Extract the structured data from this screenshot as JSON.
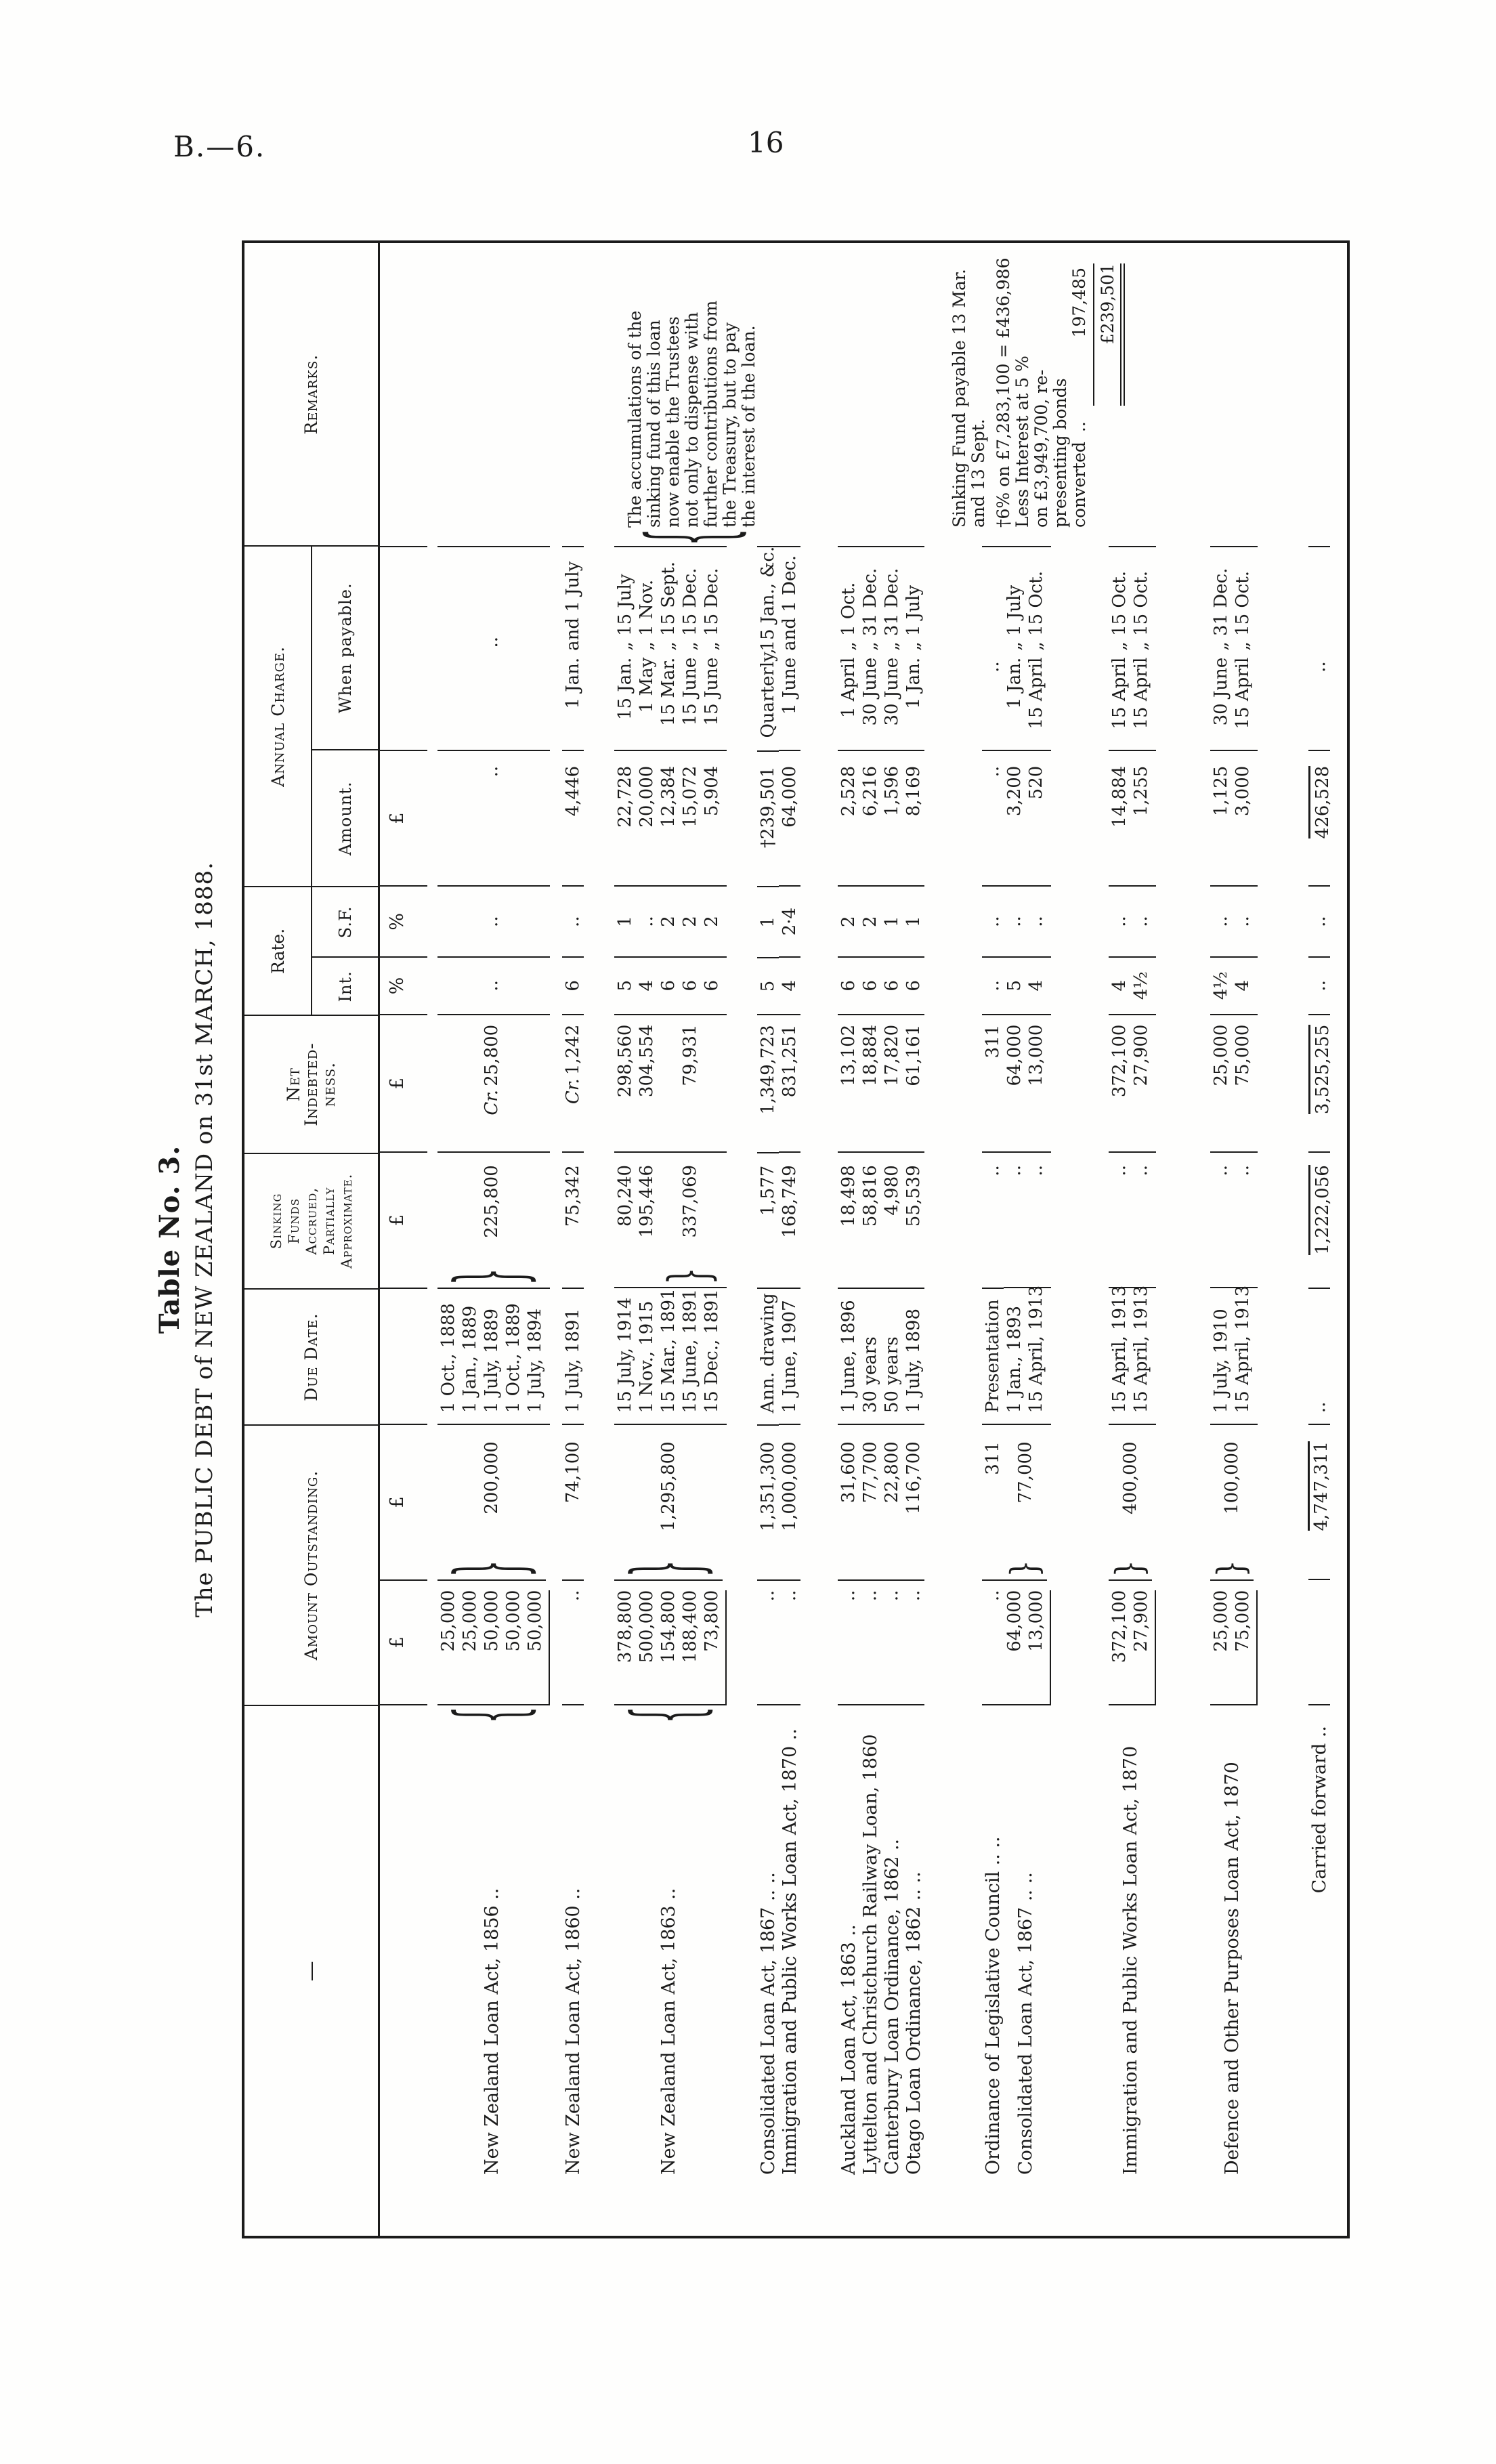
{
  "page": {
    "doc_ref": "B.—6.",
    "page_number": "16"
  },
  "title": {
    "table_no": "Table No. 3.",
    "subtitle": "The PUBLIC DEBT of NEW ZEALAND on 31st MARCH, 1888."
  },
  "table": {
    "headers": {
      "name": "—",
      "amount_outstanding": "Amount Outstanding.",
      "due_date": "Due Date.",
      "sinking_funds": [
        "Sinking",
        "Funds",
        "Accrued,",
        "Partially",
        "Approximate."
      ],
      "net_indebtedness": [
        "Net",
        "Indebted-",
        "ness."
      ],
      "rate": "Rate.",
      "rate_int": "Int.",
      "rate_sf": "S.F.",
      "annual_charge": "Annual Charge.",
      "amount": "Amount.",
      "when_payable": "When payable.",
      "remarks": "Remarks."
    },
    "units": {
      "pound": "£",
      "percent": "%"
    },
    "rows": [
      {
        "n": 5,
        "name": "New Zealand Loan Act, 1856",
        "dots": " ..",
        "name_brace": 5,
        "items": [
          "25,000",
          "25,000",
          "50,000",
          "50,000",
          "50,000"
        ],
        "items_rule": true,
        "total": "200,000",
        "total_brace": 5,
        "due": [
          "1 Oct., 1888",
          "1 Jan., 1889",
          "1 July, 1889",
          "1 Oct., 1889",
          "1 July, 1894"
        ],
        "sink": [],
        "sink_brace": {
          "span": 5,
          "value": "225,800"
        },
        "net": [],
        "net_center": {
          "span": 5,
          "value": "Cr. 25,800"
        },
        "int": {
          "span": 5,
          "value": ".."
        },
        "sf": {
          "span": 5,
          "value": ".."
        },
        "amt": {
          "span": 5,
          "value": ".."
        },
        "when": {
          "span": 5,
          "value": ".."
        }
      },
      {
        "n": 1,
        "name": "New Zealand Loan Act, 1860",
        "dots": " ..",
        "items": [
          ".."
        ],
        "total": "74,100",
        "due": [
          "1 July, 1891"
        ],
        "sink": [
          "75,342"
        ],
        "net": [
          "Cr. 1,242"
        ],
        "int": [
          "6"
        ],
        "sf": [
          ".."
        ],
        "amt": [
          "4,446"
        ],
        "when": [
          [
            "1 Jan.",
            "and 1 July"
          ]
        ]
      },
      {
        "n": 5,
        "name": "New Zealand Loan Act, 1863",
        "dots": " ..",
        "name_brace": 5,
        "items": [
          "378,800",
          "500,000",
          "154,800",
          "188,400",
          "73,800"
        ],
        "items_rule": true,
        "total": "1,295,800",
        "total_brace": 5,
        "due": [
          "15 July, 1914",
          "1 Nov., 1915",
          "15 Mar., 1891",
          "15 June, 1891",
          "15 Dec., 1891"
        ],
        "sink": [
          "80,240",
          "195,446"
        ],
        "sink_brace": {
          "span": 3,
          "value": "337,069"
        },
        "net": [
          "298,560",
          "304,554"
        ],
        "net_center": {
          "span": 3,
          "value": "79,931"
        },
        "int": [
          "5",
          "4",
          "6",
          "6",
          "6"
        ],
        "sf": [
          "1",
          "..",
          "2",
          "2",
          "2"
        ],
        "amt": [
          "22,728",
          "20,000",
          "12,384",
          "15,072",
          "5,904"
        ],
        "when": [
          [
            "15 Jan.",
            "„ 15 July"
          ],
          [
            "1 May",
            "„ 1 Nov."
          ],
          [
            "15 Mar.",
            "„ 15 Sept."
          ],
          [
            "15 June",
            "„ 15 Dec."
          ],
          [
            "15 June",
            "„ 15 Dec."
          ]
        ]
      },
      {
        "n": 1,
        "name": "Consolidated Loan Act, 1867",
        "dots": " .. ..",
        "items": [
          ".."
        ],
        "total": "1,351,300",
        "due": [
          "Ann. drawing"
        ],
        "sink": [
          "1,577"
        ],
        "net": [
          "1,349,723"
        ],
        "int": [
          "5"
        ],
        "sf": [
          "1"
        ],
        "amt": [
          "†239,501"
        ],
        "when": [
          [
            "Quarterly,",
            "15 Jan., &c."
          ]
        ]
      },
      {
        "n": 1,
        "name": "Immigration and Public Works Loan Act, 1870",
        "dots": " ..",
        "items": [
          ".."
        ],
        "total": "1,000,000",
        "due": [
          "1 June, 1907"
        ],
        "sink": [
          "168,749"
        ],
        "net": [
          "831,251"
        ],
        "int": [
          "4"
        ],
        "sf": [
          "2·4"
        ],
        "amt": [
          "64,000"
        ],
        "when": [
          [
            "1 June",
            "and 1 Dec."
          ]
        ]
      },
      {
        "n": 1,
        "name": "Auckland Loan Act, 1863",
        "dots": " ..",
        "items": [
          ".."
        ],
        "total": "31,600",
        "due": [
          "1 June, 1896"
        ],
        "sink": [
          "18,498"
        ],
        "net": [
          "13,102"
        ],
        "int": [
          "6"
        ],
        "sf": [
          "2"
        ],
        "amt": [
          "2,528"
        ],
        "when": [
          [
            "1 April",
            "„ 1 Oct."
          ]
        ]
      },
      {
        "n": 1,
        "name": "Lyttelton and Christchurch Railway Loan, 1860",
        "dots": "",
        "items": [
          ".."
        ],
        "total": "77,700",
        "due": [
          "30 years"
        ],
        "sink": [
          "58,816"
        ],
        "net": [
          "18,884"
        ],
        "int": [
          "6"
        ],
        "sf": [
          "2"
        ],
        "amt": [
          "6,216"
        ],
        "when": [
          [
            "30 June",
            "„ 31 Dec."
          ]
        ]
      },
      {
        "n": 1,
        "name": "Canterbury Loan Ordinance, 1862",
        "dots": " ..",
        "items": [
          ".."
        ],
        "total": "22,800",
        "due": [
          "50 years"
        ],
        "sink": [
          "4,980"
        ],
        "net": [
          "17,820"
        ],
        "int": [
          "6"
        ],
        "sf": [
          "1"
        ],
        "amt": [
          "1,596"
        ],
        "when": [
          [
            "30 June",
            "„ 31 Dec."
          ]
        ]
      },
      {
        "n": 1,
        "name": "Otago Loan Ordinance, 1862",
        "dots": " .. ..",
        "items": [
          ".."
        ],
        "total": "116,700",
        "due": [
          "1 July, 1898"
        ],
        "sink": [
          "55,539"
        ],
        "net": [
          "61,161"
        ],
        "int": [
          "6"
        ],
        "sf": [
          "1"
        ],
        "amt": [
          "8,169"
        ],
        "when": [
          [
            "1 Jan.",
            "„ 1 July"
          ]
        ]
      },
      {
        "n": 1,
        "name": "Ordinance of Legislative Council",
        "dots": " .. ..",
        "items": [
          ".."
        ],
        "total": "311",
        "due": [
          "Presentation"
        ],
        "sink": [
          ".."
        ],
        "net": [
          "311"
        ],
        "int": [
          ".."
        ],
        "sf": [
          ".."
        ],
        "amt": [
          ".."
        ],
        "when": [
          ".."
        ]
      },
      {
        "n": 2,
        "name": "Consolidated Loan Act, 1867",
        "dots": " .. ..",
        "items": [
          "64,000",
          "13,000"
        ],
        "items_rule": true,
        "total": "77,000",
        "total_brace": 2,
        "due": [
          "1 Jan., 1893",
          "15 April, 1913"
        ],
        "sink": [
          "..",
          ".."
        ],
        "net": [
          "64,000",
          "13,000"
        ],
        "int": [
          "5",
          "4"
        ],
        "sf": [
          "..",
          ".."
        ],
        "amt": [
          "3,200",
          "520"
        ],
        "when": [
          [
            "1 Jan.",
            "„ 1 July"
          ],
          [
            "15 April",
            "„ 15 Oct."
          ]
        ]
      },
      {
        "n": 2,
        "name": "Immigration and Public Works Loan Act, 1870",
        "dots": "",
        "items": [
          "372,100",
          "27,900"
        ],
        "items_rule": true,
        "total": "400,000",
        "total_brace": 2,
        "due": [
          "15 April, 1913",
          "15 April, 1913"
        ],
        "sink": [
          "..",
          ".."
        ],
        "net": [
          "372,100",
          "27,900"
        ],
        "int": [
          "4",
          "4½"
        ],
        "sf": [
          "..",
          ".."
        ],
        "amt": [
          "14,884",
          "1,255"
        ],
        "when": [
          [
            "15 April",
            "„ 15 Oct."
          ],
          [
            "15 April",
            "„ 15 Oct."
          ]
        ]
      },
      {
        "n": 2,
        "name": "Defence and Other Purposes Loan Act, 1870",
        "dots": "",
        "items": [
          "25,000",
          "75,000"
        ],
        "items_rule": true,
        "total": "100,000",
        "total_brace": 2,
        "due": [
          "1 July, 1910",
          "15 April, 1913"
        ],
        "sink": [
          "..",
          ".."
        ],
        "net": [
          "25,000",
          "75,000"
        ],
        "int": [
          "4½",
          "4"
        ],
        "sf": [
          "..",
          ".."
        ],
        "amt": [
          "1,125",
          "3,000"
        ],
        "when": [
          [
            "30 June",
            "„ 31 Dec."
          ],
          [
            "15 April",
            "„ 15 Oct."
          ]
        ]
      },
      {
        "n": 1,
        "cf": true,
        "name": "Carried forward",
        "dots": " ..",
        "items": [],
        "total": "4,747,311",
        "total_rule": true,
        "due": [
          ".."
        ],
        "sink": [
          "1,222,056"
        ],
        "sink_rule": true,
        "net": [
          "3,525,255"
        ],
        "net_rule": true,
        "int": [
          ".."
        ],
        "sf": [
          ".."
        ],
        "amt": [
          "426,528"
        ],
        "amt_rule": true,
        "when": [
          ".."
        ]
      }
    ],
    "remark_blocks": [
      {
        "brace": true,
        "lines": [
          "The accumulations of the",
          "sinking fund of this loan",
          "now enable the Trustees",
          "not only to dispense with",
          "further contributions from",
          "the Treasury, but to pay",
          "the interest of the loan."
        ]
      },
      {
        "lines": [
          "Sinking Fund payable 13 Mar.",
          "and 13 Sept."
        ]
      },
      {
        "lines": [
          "†6% on £7,283,100 = £436,986",
          "Less Interest at 5 %",
          "on £3,949,700, re-",
          "presenting bonds"
        ],
        "sum_line": {
          "label": "converted",
          "dots": "..",
          "value": "197,485"
        },
        "total": "£239,501"
      }
    ]
  }
}
